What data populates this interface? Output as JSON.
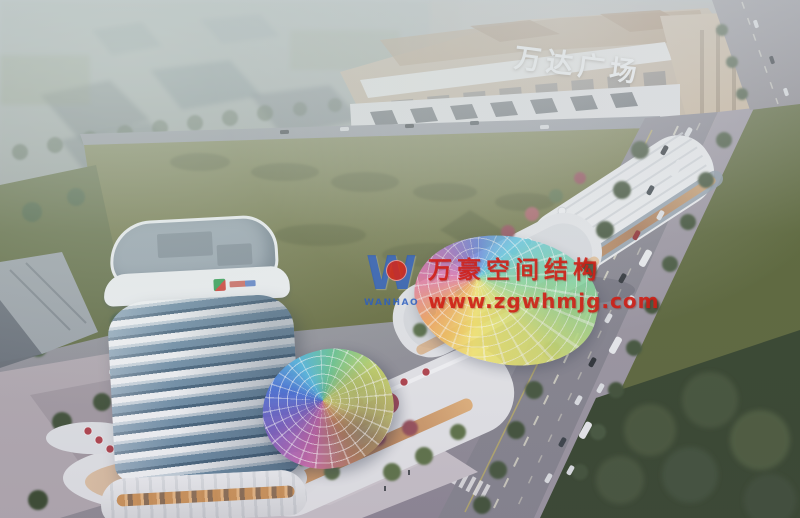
{
  "scene": {
    "description": "Aerial dusk architectural rendering of a mixed-use commercial plaza: banded high-rise tower, curved retail podium with rooftop terraces, iridescent shell canopies, large olive green field, tree-lined arterial road with buses, and a Wanda Plaza mall in the hazy background",
    "signs": {
      "background_building": "万达广场"
    },
    "watermark": {
      "logo_letter": "W",
      "logo_subtext": "WANHAO",
      "company": "万豪空间结构",
      "website": "www.zgwhmjg.com"
    },
    "palette": {
      "watermark_red": "#d21e14",
      "watermark_blue": "#2d5fc0",
      "field_green": "#6f7644",
      "lawn_green": "#5c6a3e",
      "tree_dark_green": "#3c4f36",
      "road_gray": "#85838e",
      "building_white": "#e6e8ea",
      "wanda_tan": "#bfae97",
      "tower_glass_blue": "#5e819b",
      "accent_red_band": "#a8394a",
      "umbrella_teal": "#62bac6",
      "canopy_rainbow": [
        "#f5e66a",
        "#f2a254",
        "#e06aa8",
        "#9a6cc8",
        "#5b7ede",
        "#57c4e0",
        "#7fd49a"
      ]
    }
  }
}
